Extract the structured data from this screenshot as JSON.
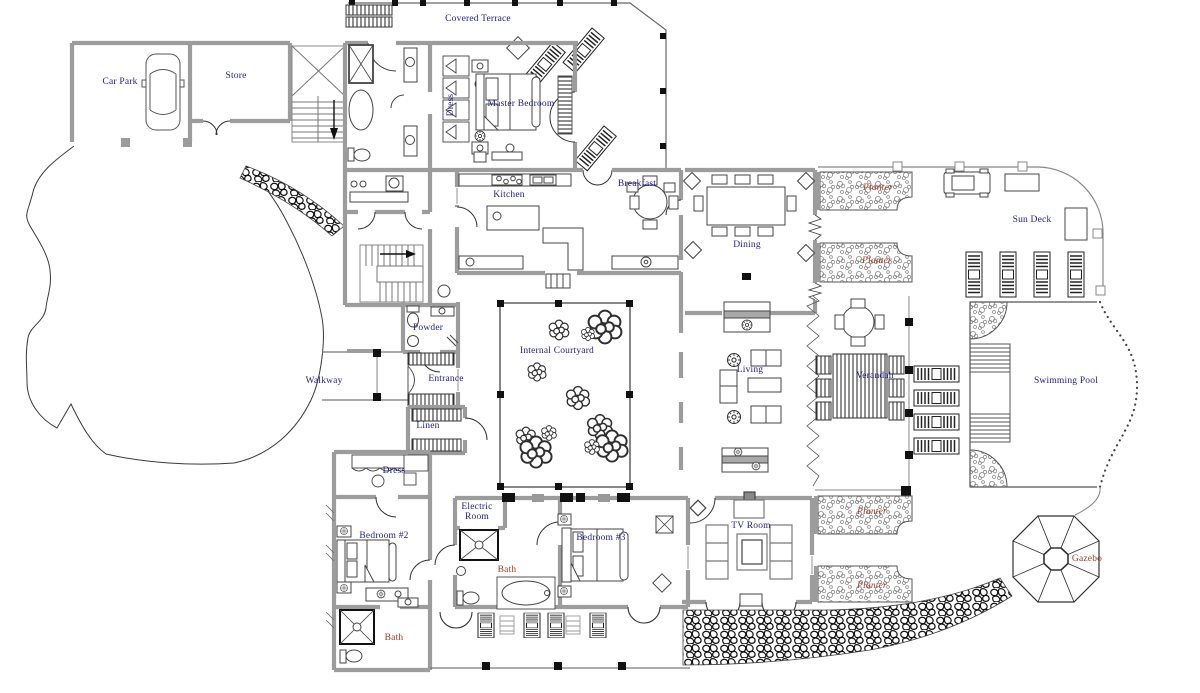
{
  "drawing": {
    "type": "architectural-floor-plan",
    "colors": {
      "navy": "#22228a",
      "red": "#9d3a26",
      "wall": "#9c9c9c",
      "line": "#444444"
    },
    "labels": [
      {
        "id": "car-park",
        "text": "Car Park",
        "x": 120,
        "y": 83,
        "color": "navy"
      },
      {
        "id": "store",
        "text": "Store",
        "x": 236,
        "y": 77,
        "color": "navy"
      },
      {
        "id": "covered-terrace",
        "text": "Covered Terrace",
        "x": 478,
        "y": 20,
        "color": "navy"
      },
      {
        "id": "master-bedroom",
        "text": "Master Bedroom",
        "x": 521,
        "y": 105,
        "color": "navy"
      },
      {
        "id": "dress-master",
        "text": "Dress",
        "x": 452,
        "y": 105,
        "color": "navy",
        "rotate": true
      },
      {
        "id": "kitchen",
        "text": "Kitchen",
        "x": 509,
        "y": 196,
        "color": "navy"
      },
      {
        "id": "breakfast",
        "text": "Breakfast",
        "x": 637,
        "y": 185,
        "color": "navy"
      },
      {
        "id": "dining",
        "text": "Dining",
        "x": 747,
        "y": 246,
        "color": "navy"
      },
      {
        "id": "planter-ne-1",
        "text": "Planter",
        "x": 878,
        "y": 189,
        "color": "red",
        "italic": true
      },
      {
        "id": "planter-ne-2",
        "text": "Planter",
        "x": 877,
        "y": 262,
        "color": "red",
        "italic": true
      },
      {
        "id": "sun-deck",
        "text": "Sun Deck",
        "x": 1032,
        "y": 221,
        "color": "navy"
      },
      {
        "id": "internal-courtyard",
        "text": "Internal Courtyard",
        "x": 557,
        "y": 352,
        "color": "navy"
      },
      {
        "id": "living",
        "text": "Living",
        "x": 750,
        "y": 371,
        "color": "navy"
      },
      {
        "id": "verandah",
        "text": "Verandah",
        "x": 875,
        "y": 377,
        "color": "navy"
      },
      {
        "id": "swimming-pool",
        "text": "Swimming Pool",
        "x": 1066,
        "y": 382,
        "color": "navy"
      },
      {
        "id": "walkway",
        "text": "Walkway",
        "x": 324,
        "y": 382,
        "color": "navy"
      },
      {
        "id": "powder",
        "text": "Powder",
        "x": 428,
        "y": 329,
        "color": "navy"
      },
      {
        "id": "entrance",
        "text": "Entrance",
        "x": 446,
        "y": 380,
        "color": "navy"
      },
      {
        "id": "linen",
        "text": "Linen",
        "x": 428,
        "y": 427,
        "color": "navy"
      },
      {
        "id": "dress-bedroom2",
        "text": "Dress",
        "x": 394,
        "y": 472,
        "color": "navy"
      },
      {
        "id": "electric-room",
        "text": "Electric Room",
        "x": 477,
        "y": 513,
        "color": "navy",
        "multiline": true
      },
      {
        "id": "bedroom-2",
        "text": "Bedroom #2",
        "x": 384,
        "y": 537,
        "color": "navy"
      },
      {
        "id": "bath-center",
        "text": "Bath",
        "x": 507,
        "y": 571,
        "color": "red"
      },
      {
        "id": "bath-bedroom2",
        "text": "Bath",
        "x": 394,
        "y": 639,
        "color": "red"
      },
      {
        "id": "bedroom-3",
        "text": "Bedroom #3",
        "x": 601,
        "y": 539,
        "color": "navy"
      },
      {
        "id": "tv-room",
        "text": "TV Room",
        "x": 751,
        "y": 527,
        "color": "navy"
      },
      {
        "id": "planter-se-1",
        "text": "Planter",
        "x": 872,
        "y": 513,
        "color": "red",
        "italic": true
      },
      {
        "id": "planter-se-2",
        "text": "Planter",
        "x": 872,
        "y": 587,
        "color": "red",
        "italic": true
      },
      {
        "id": "gazebo",
        "text": "Gazebo",
        "x": 1087,
        "y": 560,
        "color": "red"
      }
    ]
  }
}
